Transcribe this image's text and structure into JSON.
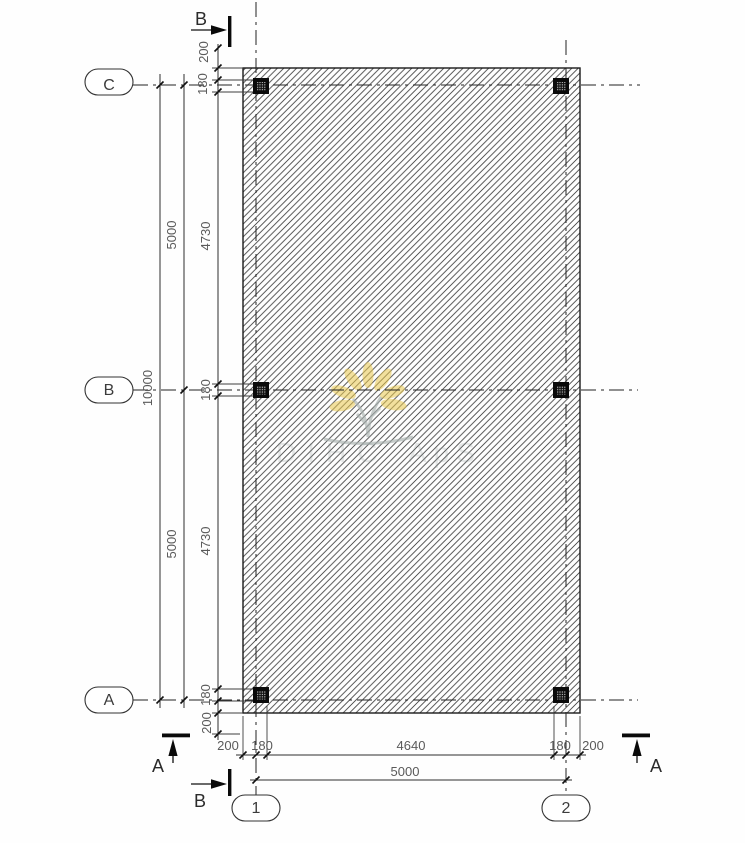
{
  "title": "Structural slab plan with columns",
  "grid": {
    "row_labels": [
      {
        "label": "C"
      },
      {
        "label": "B"
      },
      {
        "label": "A"
      }
    ],
    "col_labels": [
      {
        "label": "1"
      },
      {
        "label": "2"
      }
    ]
  },
  "sections": {
    "top": "B",
    "bottom": "B",
    "left": "A",
    "right": "A"
  },
  "dims": {
    "v_chain": [
      "200",
      "180",
      "4730",
      "180",
      "4730",
      "180",
      "200"
    ],
    "v_mid": [
      "5000",
      "5000"
    ],
    "v_overall": "10000",
    "h_chain": [
      "200",
      "180",
      "4640",
      "180",
      "200"
    ],
    "h_overall": "5000"
  },
  "watermark": {
    "left_text": "DIHC",
    "right_text": "ApS",
    "petal_color": "#eac94f",
    "branch_color": "#a7b0ae",
    "text_color": "#7f8c8c"
  },
  "colors": {
    "hatch": "#3f3f3f",
    "line": "#222222",
    "column": "#0a0a0a"
  }
}
